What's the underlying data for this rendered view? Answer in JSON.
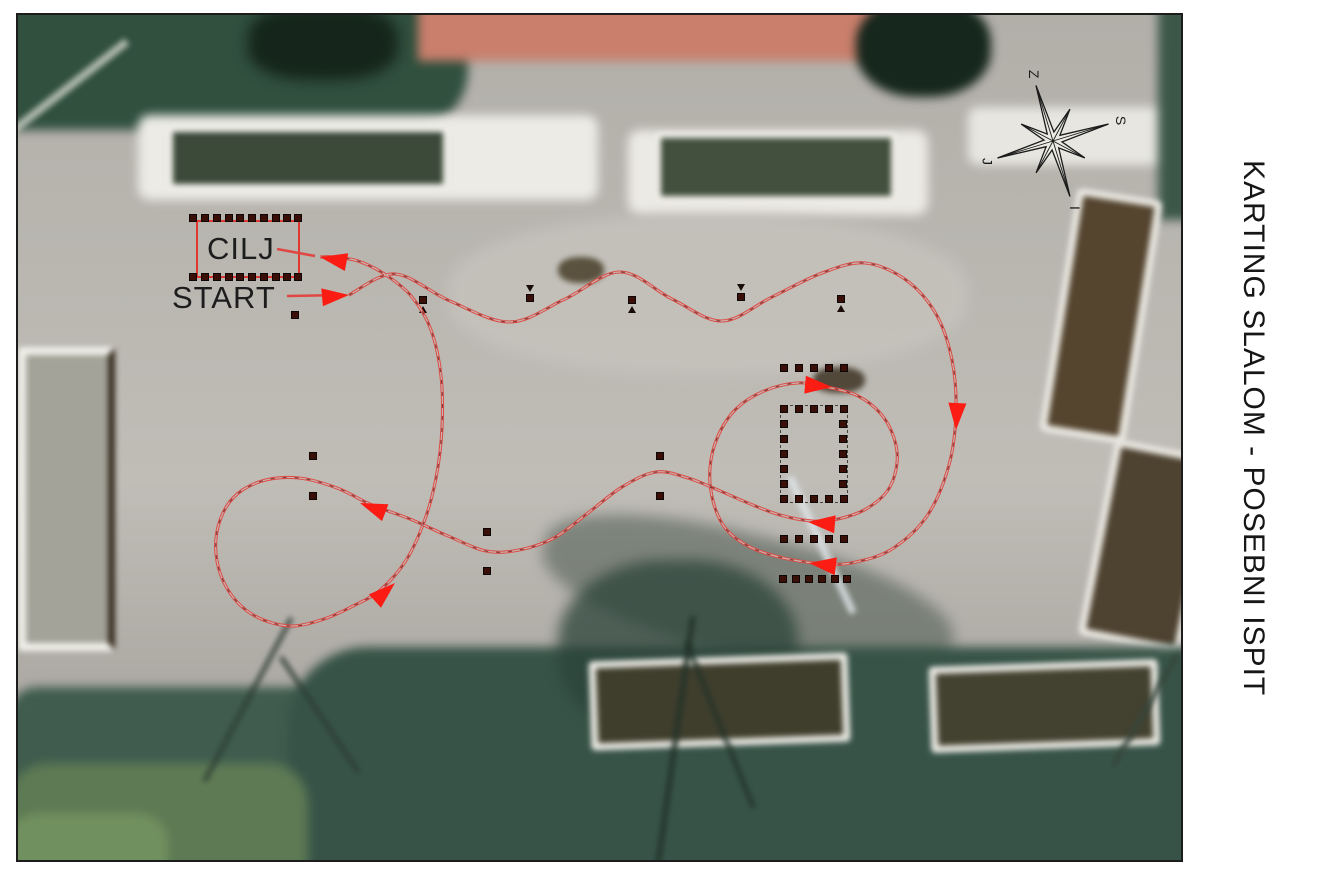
{
  "title": {
    "text": "KARTING SLALOM - POSEBNI ISPIT"
  },
  "labels": {
    "finish": "CILJ",
    "start": "START"
  },
  "compass": {
    "center": {
      "x": 1053,
      "y": 141
    },
    "letters": {
      "top": "Z",
      "right": "S",
      "bottom": "I",
      "left": "J"
    }
  },
  "colors": {
    "course_line": "#e04742",
    "course_dash": "#6b1511",
    "arrow": "#fb1d14",
    "finish_box": "#e03730",
    "cone": "#3a0f08",
    "text": "#1d1d1d"
  },
  "course": {
    "start_connector": [
      [
        287,
        296
      ],
      [
        344,
        295
      ]
    ],
    "finish_connector": [
      [
        277,
        249
      ],
      [
        315,
        256
      ]
    ],
    "path_points": [
      [
        349,
        295
      ],
      [
        395,
        274
      ],
      [
        450,
        301
      ],
      [
        510,
        322
      ],
      [
        565,
        299
      ],
      [
        620,
        272
      ],
      [
        672,
        299
      ],
      [
        722,
        321
      ],
      [
        772,
        297
      ],
      [
        822,
        273
      ],
      [
        865,
        263
      ],
      [
        906,
        280
      ],
      [
        936,
        314
      ],
      [
        952,
        360
      ],
      [
        956,
        412
      ],
      [
        949,
        465
      ],
      [
        927,
        516
      ],
      [
        892,
        549
      ],
      [
        856,
        562
      ],
      [
        828,
        564
      ],
      [
        788,
        559
      ],
      [
        752,
        548
      ],
      [
        726,
        529
      ],
      [
        713,
        501
      ],
      [
        710,
        468
      ],
      [
        718,
        436
      ],
      [
        736,
        409
      ],
      [
        764,
        391
      ],
      [
        797,
        383
      ],
      [
        827,
        387
      ],
      [
        858,
        396
      ],
      [
        881,
        414
      ],
      [
        894,
        438
      ],
      [
        897,
        463
      ],
      [
        888,
        490
      ],
      [
        866,
        509
      ],
      [
        838,
        519
      ],
      [
        812,
        521
      ],
      [
        780,
        515
      ],
      [
        748,
        503
      ],
      [
        718,
        490
      ],
      [
        688,
        478
      ],
      [
        656,
        472
      ],
      [
        622,
        487
      ],
      [
        588,
        513
      ],
      [
        554,
        538
      ],
      [
        519,
        550
      ],
      [
        486,
        551
      ],
      [
        448,
        536
      ],
      [
        410,
        519
      ],
      [
        372,
        505
      ],
      [
        337,
        488
      ],
      [
        299,
        478
      ],
      [
        262,
        481
      ],
      [
        233,
        498
      ],
      [
        218,
        527
      ],
      [
        217,
        561
      ],
      [
        230,
        593
      ],
      [
        255,
        616
      ],
      [
        290,
        626
      ],
      [
        324,
        619
      ],
      [
        353,
        606
      ],
      [
        379,
        591
      ],
      [
        405,
        562
      ],
      [
        424,
        522
      ],
      [
        436,
        478
      ],
      [
        442,
        428
      ],
      [
        441,
        376
      ],
      [
        431,
        330
      ],
      [
        412,
        297
      ],
      [
        386,
        275
      ],
      [
        358,
        261
      ],
      [
        333,
        257
      ],
      [
        320,
        257
      ]
    ],
    "arrows": [
      {
        "name": "start-arrow",
        "x": 349,
        "y": 295,
        "angle": -5
      },
      {
        "name": "right-side-down",
        "x": 956,
        "y": 430,
        "angle": 93
      },
      {
        "name": "lower-pass-left",
        "x": 809,
        "y": 563,
        "angle": 187
      },
      {
        "name": "circle-top-right",
        "x": 832,
        "y": 387,
        "angle": 5
      },
      {
        "name": "circle-bottom-left",
        "x": 808,
        "y": 522,
        "angle": 185
      },
      {
        "name": "loop-entry-left",
        "x": 360,
        "y": 503,
        "angle": 201
      },
      {
        "name": "loop-exit-upright",
        "x": 395,
        "y": 583,
        "angle": -42
      },
      {
        "name": "finish-arrow",
        "x": 320,
        "y": 257,
        "angle": 191
      }
    ]
  },
  "cones": {
    "finish_row_top": [
      [
        193,
        218
      ],
      [
        205,
        218
      ],
      [
        217,
        218
      ],
      [
        229,
        218
      ],
      [
        240,
        218
      ],
      [
        252,
        218
      ],
      [
        264,
        218
      ],
      [
        276,
        218
      ],
      [
        287,
        218
      ],
      [
        298,
        218
      ]
    ],
    "finish_row_bottom": [
      [
        193,
        277
      ],
      [
        205,
        277
      ],
      [
        217,
        277
      ],
      [
        229,
        277
      ],
      [
        240,
        277
      ],
      [
        252,
        277
      ],
      [
        264,
        277
      ],
      [
        276,
        277
      ],
      [
        287,
        277
      ],
      [
        298,
        277
      ]
    ],
    "slalom_row": [
      {
        "x": 423,
        "y": 300,
        "mark": "below"
      },
      {
        "x": 530,
        "y": 298,
        "mark": "above"
      },
      {
        "x": 632,
        "y": 300,
        "mark": "below"
      },
      {
        "x": 741,
        "y": 297,
        "mark": "above"
      },
      {
        "x": 841,
        "y": 299,
        "mark": "below"
      }
    ],
    "row_above_garage": [
      [
        784,
        368
      ],
      [
        799,
        368
      ],
      [
        814,
        368
      ],
      [
        829,
        368
      ],
      [
        844,
        368
      ]
    ],
    "garage_top": [
      [
        784,
        409
      ],
      [
        799,
        409
      ],
      [
        814,
        409
      ],
      [
        829,
        409
      ],
      [
        844,
        409
      ]
    ],
    "garage_left": [
      [
        784,
        424
      ],
      [
        784,
        439
      ],
      [
        784,
        454
      ],
      [
        784,
        469
      ],
      [
        784,
        484
      ]
    ],
    "garage_right": [
      [
        843,
        424
      ],
      [
        843,
        439
      ],
      [
        843,
        454
      ],
      [
        843,
        469
      ],
      [
        843,
        484
      ]
    ],
    "garage_bottom": [
      [
        784,
        499
      ],
      [
        799,
        499
      ],
      [
        814,
        499
      ],
      [
        829,
        499
      ],
      [
        844,
        499
      ]
    ],
    "row_below_garage": [
      [
        784,
        539
      ],
      [
        799,
        539
      ],
      [
        814,
        539
      ],
      [
        829,
        539
      ],
      [
        844,
        539
      ]
    ],
    "row_bottom": [
      [
        783,
        579
      ],
      [
        796,
        579
      ],
      [
        809,
        579
      ],
      [
        822,
        579
      ],
      [
        835,
        579
      ],
      [
        847,
        579
      ]
    ],
    "singles": [
      [
        295,
        315
      ],
      [
        313,
        456
      ],
      [
        313,
        496
      ],
      [
        660,
        456
      ],
      [
        660,
        496
      ],
      [
        487,
        532
      ],
      [
        487,
        571
      ]
    ]
  }
}
